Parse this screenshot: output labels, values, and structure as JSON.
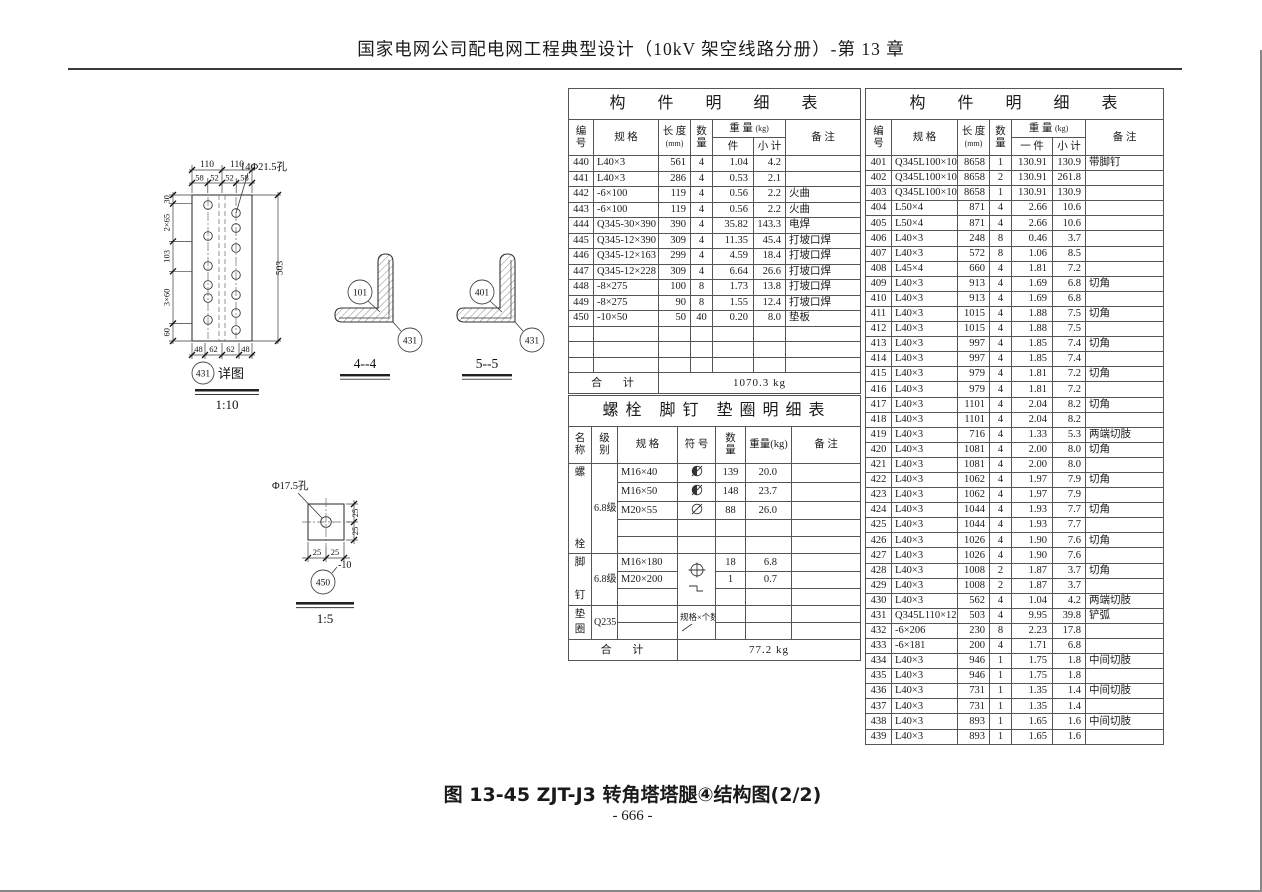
{
  "header": {
    "title": "国家电网公司配电网工程典型设计（10kV 架空线路分册）-第 13 章"
  },
  "caption": {
    "figure": "图 13-45  ZJT-J3 转角塔塔腿④结构图(2/2)",
    "page": "- 666 -"
  },
  "parts_table_left": {
    "title": "构 件 明 细 表",
    "headers": {
      "id": "编\n号",
      "spec": "规  格",
      "length": "长 度",
      "length_unit": "(mm)",
      "qty": "数\n量",
      "weight": "重 量",
      "weight_unit": "(kg)",
      "per": "件",
      "subtotal": "小 计",
      "remark": "备  注"
    },
    "rows": [
      [
        "440",
        "L40×3",
        "561",
        "4",
        "1.04",
        "4.2",
        ""
      ],
      [
        "441",
        "L40×3",
        "286",
        "4",
        "0.53",
        "2.1",
        ""
      ],
      [
        "442",
        "-6×100",
        "119",
        "4",
        "0.56",
        "2.2",
        "火曲"
      ],
      [
        "443",
        "-6×100",
        "119",
        "4",
        "0.56",
        "2.2",
        "火曲"
      ],
      [
        "444",
        "Q345-30×390",
        "390",
        "4",
        "35.82",
        "143.3",
        "电焊"
      ],
      [
        "445",
        "Q345-12×390",
        "309",
        "4",
        "11.35",
        "45.4",
        "打坡口焊"
      ],
      [
        "446",
        "Q345-12×163",
        "299",
        "4",
        "4.59",
        "18.4",
        "打坡口焊"
      ],
      [
        "447",
        "Q345-12×228",
        "309",
        "4",
        "6.64",
        "26.6",
        "打坡口焊"
      ],
      [
        "448",
        "-8×275",
        "100",
        "8",
        "1.73",
        "13.8",
        "打坡口焊"
      ],
      [
        "449",
        "-8×275",
        "90",
        "8",
        "1.55",
        "12.4",
        "打坡口焊"
      ],
      [
        "450",
        "-10×50",
        "50",
        "40",
        "0.20",
        "8.0",
        "垫板"
      ],
      [
        "",
        "",
        "",
        "",
        "",
        "",
        ""
      ],
      [
        "",
        "",
        "",
        "",
        "",
        "",
        ""
      ],
      [
        "",
        "",
        "",
        "",
        "",
        "",
        ""
      ]
    ],
    "total_label": "合 计",
    "total_value": "1070.3 kg"
  },
  "parts_table_right": {
    "title": "构 件 明 细 表",
    "headers": {
      "id": "编\n号",
      "spec": "规  格",
      "length": "长 度",
      "length_unit": "(mm)",
      "qty": "数\n量",
      "weight": "重 量",
      "weight_unit": "(kg)",
      "per": "一 件",
      "subtotal": "小 计",
      "remark": "备  注"
    },
    "rows": [
      [
        "401",
        "Q345L100×10",
        "8658",
        "1",
        "130.91",
        "130.9",
        "带脚钉"
      ],
      [
        "402",
        "Q345L100×10",
        "8658",
        "2",
        "130.91",
        "261.8",
        ""
      ],
      [
        "403",
        "Q345L100×10",
        "8658",
        "1",
        "130.91",
        "130.9",
        ""
      ],
      [
        "404",
        "L50×4",
        "871",
        "4",
        "2.66",
        "10.6",
        ""
      ],
      [
        "405",
        "L50×4",
        "871",
        "4",
        "2.66",
        "10.6",
        ""
      ],
      [
        "406",
        "L40×3",
        "248",
        "8",
        "0.46",
        "3.7",
        ""
      ],
      [
        "407",
        "L40×3",
        "572",
        "8",
        "1.06",
        "8.5",
        ""
      ],
      [
        "408",
        "L45×4",
        "660",
        "4",
        "1.81",
        "7.2",
        ""
      ],
      [
        "409",
        "L40×3",
        "913",
        "4",
        "1.69",
        "6.8",
        "切角"
      ],
      [
        "410",
        "L40×3",
        "913",
        "4",
        "1.69",
        "6.8",
        ""
      ],
      [
        "411",
        "L40×3",
        "1015",
        "4",
        "1.88",
        "7.5",
        "切角"
      ],
      [
        "412",
        "L40×3",
        "1015",
        "4",
        "1.88",
        "7.5",
        ""
      ],
      [
        "413",
        "L40×3",
        "997",
        "4",
        "1.85",
        "7.4",
        "切角"
      ],
      [
        "414",
        "L40×3",
        "997",
        "4",
        "1.85",
        "7.4",
        ""
      ],
      [
        "415",
        "L40×3",
        "979",
        "4",
        "1.81",
        "7.2",
        "切角"
      ],
      [
        "416",
        "L40×3",
        "979",
        "4",
        "1.81",
        "7.2",
        ""
      ],
      [
        "417",
        "L40×3",
        "1101",
        "4",
        "2.04",
        "8.2",
        "切角"
      ],
      [
        "418",
        "L40×3",
        "1101",
        "4",
        "2.04",
        "8.2",
        ""
      ],
      [
        "419",
        "L40×3",
        "716",
        "4",
        "1.33",
        "5.3",
        "两端切肢"
      ],
      [
        "420",
        "L40×3",
        "1081",
        "4",
        "2.00",
        "8.0",
        "切角"
      ],
      [
        "421",
        "L40×3",
        "1081",
        "4",
        "2.00",
        "8.0",
        ""
      ],
      [
        "422",
        "L40×3",
        "1062",
        "4",
        "1.97",
        "7.9",
        "切角"
      ],
      [
        "423",
        "L40×3",
        "1062",
        "4",
        "1.97",
        "7.9",
        ""
      ],
      [
        "424",
        "L40×3",
        "1044",
        "4",
        "1.93",
        "7.7",
        "切角"
      ],
      [
        "425",
        "L40×3",
        "1044",
        "4",
        "1.93",
        "7.7",
        ""
      ],
      [
        "426",
        "L40×3",
        "1026",
        "4",
        "1.90",
        "7.6",
        "切角"
      ],
      [
        "427",
        "L40×3",
        "1026",
        "4",
        "1.90",
        "7.6",
        ""
      ],
      [
        "428",
        "L40×3",
        "1008",
        "2",
        "1.87",
        "3.7",
        "切角"
      ],
      [
        "429",
        "L40×3",
        "1008",
        "2",
        "1.87",
        "3.7",
        ""
      ],
      [
        "430",
        "L40×3",
        "562",
        "4",
        "1.04",
        "4.2",
        "两端切肢"
      ],
      [
        "431",
        "Q345L110×12",
        "503",
        "4",
        "9.95",
        "39.8",
        "铲弧"
      ],
      [
        "432",
        "-6×206",
        "230",
        "8",
        "2.23",
        "17.8",
        ""
      ],
      [
        "433",
        "-6×181",
        "200",
        "4",
        "1.71",
        "6.8",
        ""
      ],
      [
        "434",
        "L40×3",
        "946",
        "1",
        "1.75",
        "1.8",
        "中间切肢"
      ],
      [
        "435",
        "L40×3",
        "946",
        "1",
        "1.75",
        "1.8",
        ""
      ],
      [
        "436",
        "L40×3",
        "731",
        "1",
        "1.35",
        "1.4",
        "中间切肢"
      ],
      [
        "437",
        "L40×3",
        "731",
        "1",
        "1.35",
        "1.4",
        ""
      ],
      [
        "438",
        "L40×3",
        "893",
        "1",
        "1.65",
        "1.6",
        "中间切肢"
      ],
      [
        "439",
        "L40×3",
        "893",
        "1",
        "1.65",
        "1.6",
        ""
      ]
    ]
  },
  "bolt_table": {
    "title": "螺栓 脚钉 垫圈明细表",
    "headers": {
      "name": "名\n称",
      "grade": "级\n别",
      "spec": "规  格",
      "symbol": "符 号",
      "qty": "数\n量",
      "weight": "重量(kg)",
      "remark": "备  注"
    },
    "groups": [
      {
        "name": "螺栓",
        "grade": "6.8级",
        "rows": [
          {
            "spec": "M16×40",
            "symbol": "bolt-half",
            "qty": "139",
            "weight": "20.0",
            "remark": ""
          },
          {
            "spec": "M16×50",
            "symbol": "bolt-half",
            "qty": "148",
            "weight": "23.7",
            "remark": ""
          },
          {
            "spec": "M20×55",
            "symbol": "bolt-open",
            "qty": "88",
            "weight": "26.0",
            "remark": ""
          },
          {
            "spec": "",
            "symbol": "",
            "qty": "",
            "weight": "",
            "remark": ""
          },
          {
            "spec": "",
            "symbol": "",
            "qty": "",
            "weight": "",
            "remark": ""
          }
        ]
      },
      {
        "name": "脚钉",
        "grade": "6.8级",
        "group_symbol": "foot-nail",
        "rows": [
          {
            "spec": "M16×180",
            "qty": "18",
            "weight": "6.8",
            "remark": ""
          },
          {
            "spec": "M20×200",
            "qty": "1",
            "weight": "0.7",
            "remark": ""
          },
          {
            "spec": "",
            "qty": "",
            "weight": "",
            "remark": ""
          }
        ]
      },
      {
        "name": "垫圈",
        "grade": "Q235",
        "symbol_note": "规格×个数",
        "rows": [
          {
            "spec": "",
            "qty": "",
            "weight": "",
            "remark": ""
          },
          {
            "spec": "",
            "qty": "",
            "weight": "",
            "remark": ""
          }
        ]
      }
    ],
    "total_label": "合 计",
    "total_value": "77.2 kg"
  },
  "drawings": {
    "detail_431": {
      "balloon": "431",
      "title_suffix": "详图",
      "scale": "1:10",
      "hole_label": "14Φ21.5孔",
      "dims_top_outer": [
        "110",
        "110"
      ],
      "dims_top_inner": [
        "58",
        "52",
        "52",
        "58"
      ],
      "dims_left": [
        "30",
        "2×65",
        "103",
        "3×60",
        "60"
      ],
      "dim_right": "503",
      "dims_bottom": [
        "48",
        "62",
        "62",
        "48"
      ]
    },
    "section_44": {
      "label": "4--4",
      "balloon_inner": "101",
      "balloon_outer": "431"
    },
    "section_55": {
      "label": "5--5",
      "balloon_inner": "401",
      "balloon_outer": "431"
    },
    "detail_450": {
      "balloon": "450",
      "plate_mark": "-10",
      "scale": "1:5",
      "hole_label": "Φ17.5孔",
      "dims_right": [
        "25",
        "25"
      ],
      "dims_bottom": [
        "25",
        "25"
      ]
    }
  }
}
